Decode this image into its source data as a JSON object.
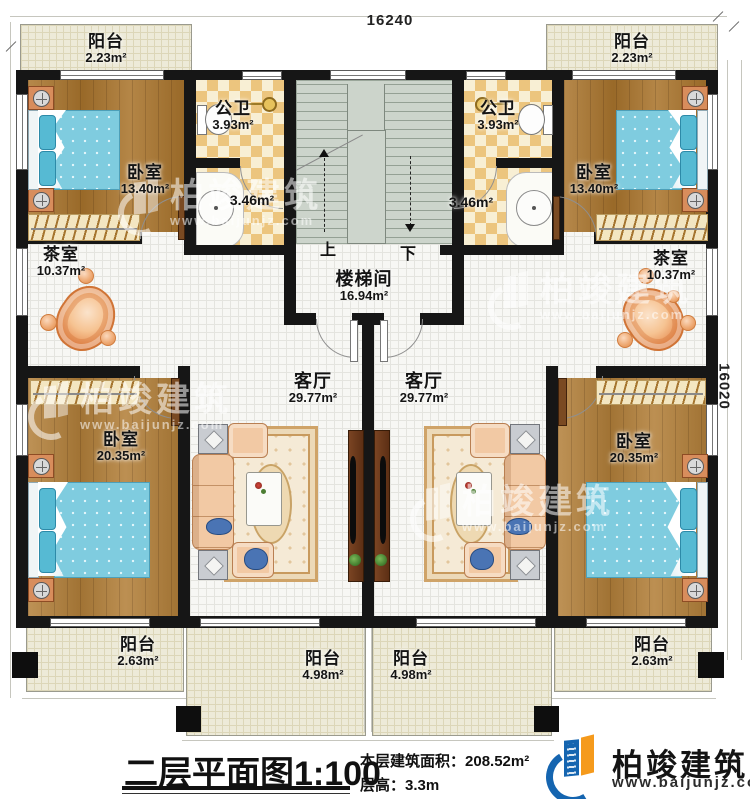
{
  "dims": {
    "top": "16240",
    "right": "16020"
  },
  "rooms": {
    "balcony_tl": {
      "name": "阳台",
      "area": "2.23m²"
    },
    "balcony_tr": {
      "name": "阳台",
      "area": "2.23m²"
    },
    "bedroom_tl": {
      "name": "卧室",
      "area": "13.40m²"
    },
    "bedroom_tr": {
      "name": "卧室",
      "area": "13.40m²"
    },
    "bath_l": {
      "name": "公卫",
      "area": "3.93m²"
    },
    "bath_r": {
      "name": "公卫",
      "area": "3.93m²"
    },
    "wash_l": {
      "area": "3.46m²"
    },
    "wash_r": {
      "area": "3.46m²"
    },
    "stairwell": {
      "name": "楼梯间",
      "area": "16.94m²",
      "up": "上",
      "down": "下"
    },
    "tea_l": {
      "name": "茶室",
      "area": "10.37m²"
    },
    "tea_r": {
      "name": "茶室",
      "area": "10.37m²"
    },
    "living_l": {
      "name": "客厅",
      "area": "29.77m²"
    },
    "living_r": {
      "name": "客厅",
      "area": "29.77m²"
    },
    "bedroom_bl": {
      "name": "卧室",
      "area": "20.35m²"
    },
    "bedroom_br": {
      "name": "卧室",
      "area": "20.35m²"
    },
    "balcony_bl": {
      "name": "阳台",
      "area": "2.63m²"
    },
    "balcony_br": {
      "name": "阳台",
      "area": "2.63m²"
    },
    "balcony_bcl": {
      "name": "阳台",
      "area": "4.98m²"
    },
    "balcony_bcr": {
      "name": "阳台",
      "area": "4.98m²"
    }
  },
  "title": {
    "main": "二层平面图",
    "scale": "1:100",
    "area_label": "本层建筑面积：",
    "area_value": "208.52m²",
    "height_label": "层高：",
    "height_value": "3.3m"
  },
  "brand": {
    "name": "柏竣建筑",
    "url": "www.baijunjz.com"
  },
  "watermark": {
    "name": "柏竣建筑",
    "url": "www.baijunjz.com"
  },
  "colors": {
    "wall": "#161616",
    "wood_floor": "#aa752d",
    "tile_floor": "#f7f7f4",
    "checker_gold": "#ecc57e",
    "balcony": "#edead8",
    "stair": "#ccd4cb",
    "bed_blue": "#7fccdf",
    "sofa_peach": "#f2c9a4",
    "brand_blue": "#1565b0",
    "brand_orange": "#f59a1c"
  }
}
